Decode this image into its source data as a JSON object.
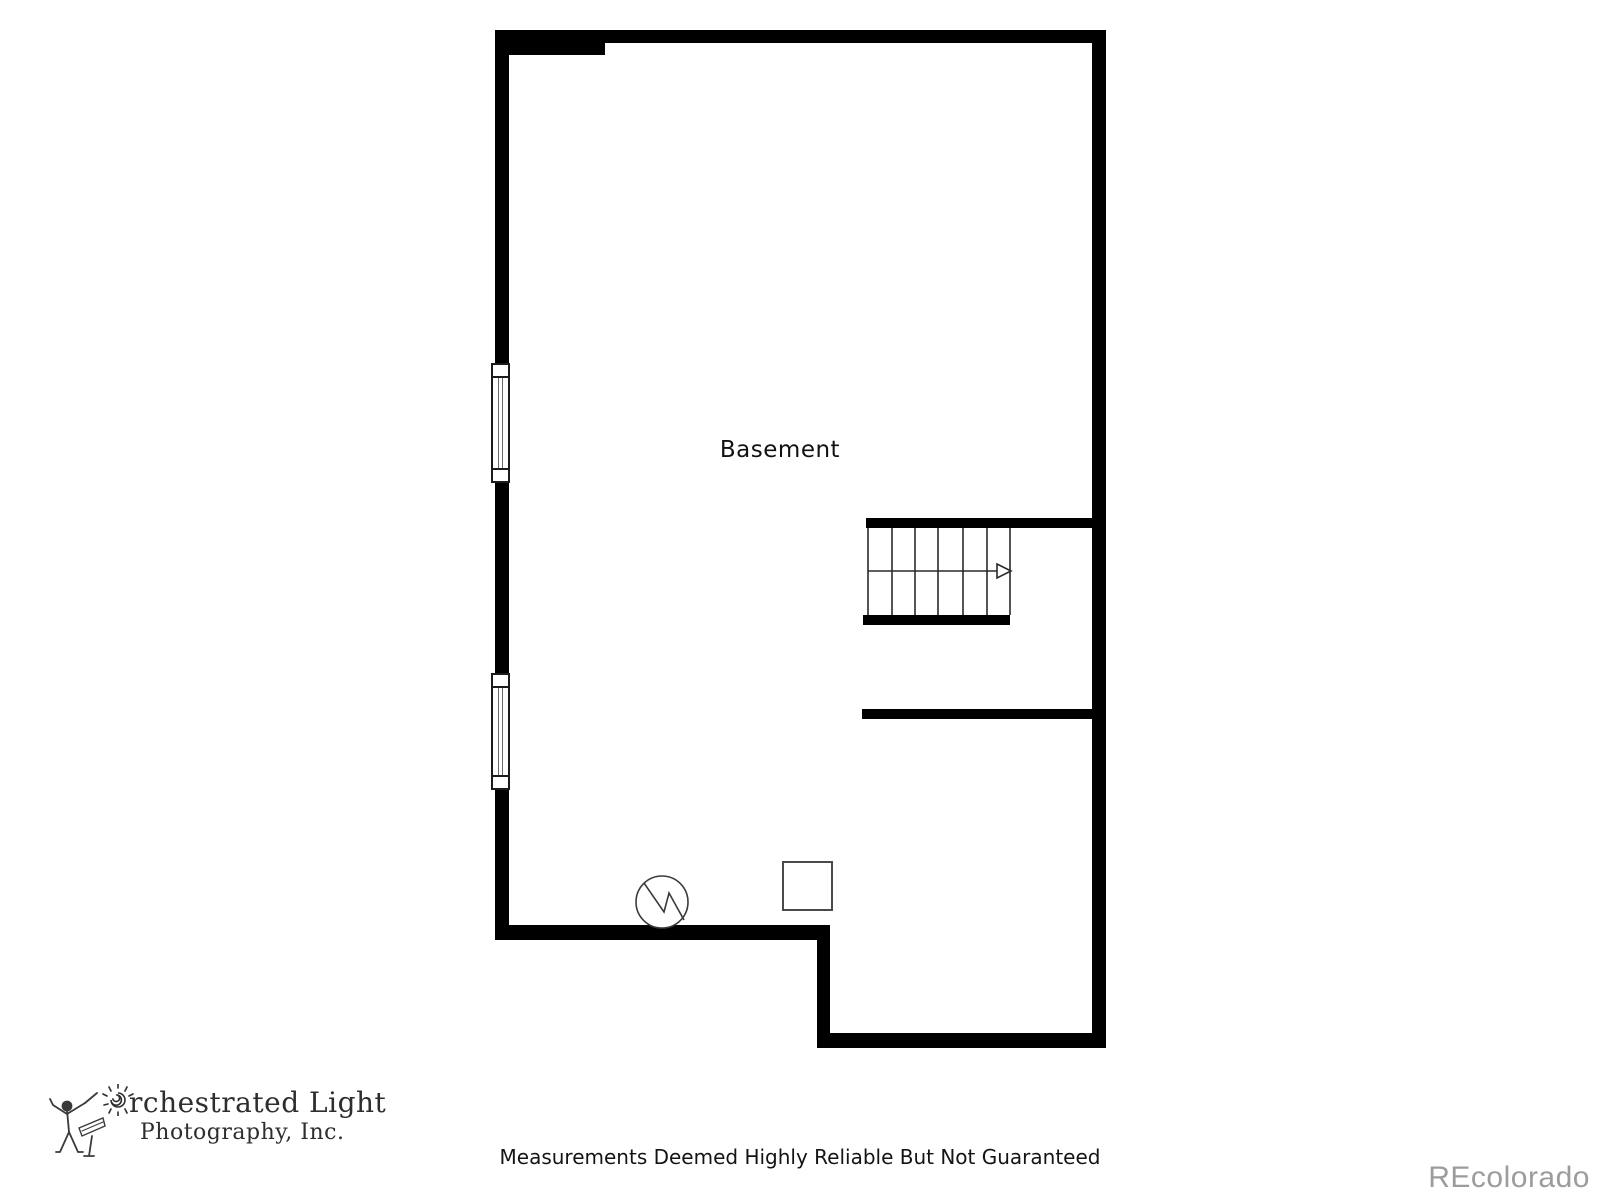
{
  "page": {
    "background_color": "#ffffff",
    "wall_color": "#000000",
    "line_color": "#2a2a2a"
  },
  "plan": {
    "room_label": "Basement",
    "stairs": {
      "tread_count": 6,
      "direction_icon": "right-arrow",
      "direction": "right"
    },
    "symbols": {
      "electrical_symbol": "circle-with-zigzag",
      "post_symbol": "square-outline"
    },
    "window_count": 2
  },
  "footer": {
    "disclaimer": "Measurements Deemed Highly Reliable But Not Guaranteed",
    "watermark": "REcolorado",
    "watermark_color": "#9c9c9c"
  },
  "logo": {
    "line1": "rchestrated Light",
    "line2": "Photography, Inc.",
    "o_glyph": "sun-spiral",
    "figure_glyph": "conductor-stick-figure",
    "color": "#2e2e2e"
  }
}
